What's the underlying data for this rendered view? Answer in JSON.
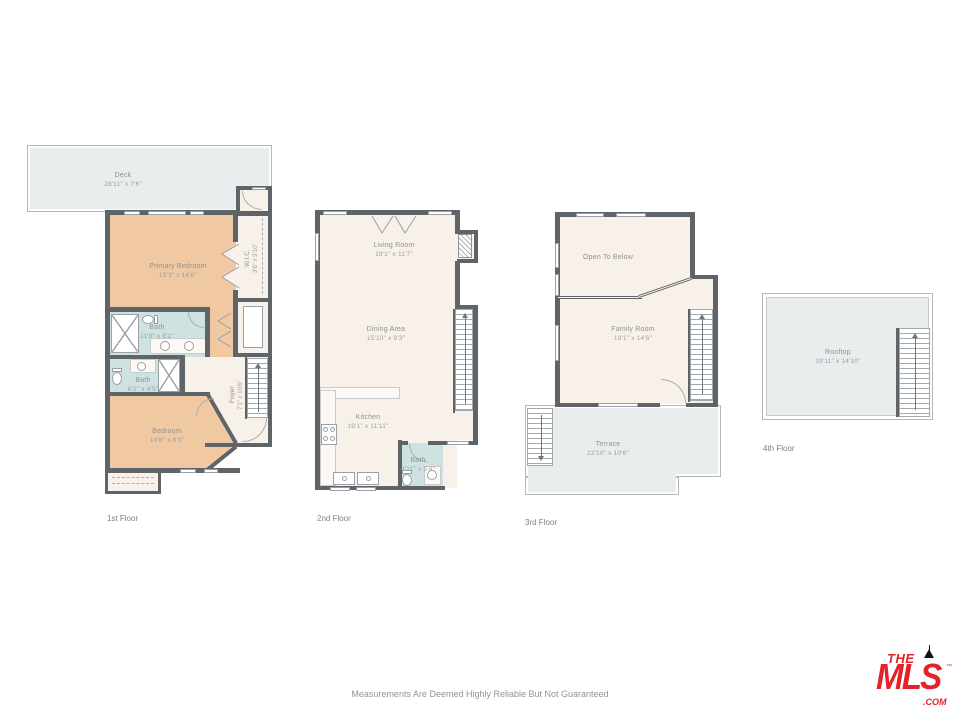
{
  "page": {
    "disclaimer": "Measurements Are Deemed Highly Reliable But Not Guaranteed"
  },
  "colors": {
    "walls": "#5f6468",
    "bedroom_tan": "#f0c9a3",
    "bath_blue": "#cfe2e2",
    "room_cream": "#f8f1e9",
    "outdoor_gray": "#eaedee",
    "logo_red": "#e62229"
  },
  "logo": {
    "the": "THE",
    "mls": "MLS",
    "tm": "™",
    "com": ".COM"
  },
  "floors": [
    {
      "label": "1st Floor",
      "rooms": [
        {
          "name": "Deck",
          "dims": "28'11\" x 7'6\""
        },
        {
          "name": "Primary Bedroom",
          "dims": "15'3\" x 16'6\""
        },
        {
          "name": "W.I.C.",
          "dims": "3'6\" x 9'10\""
        },
        {
          "name": "Bath",
          "dims": "11'8\" x 6'1\""
        },
        {
          "name": "Bath",
          "dims": "6'2\" x 4'5\""
        },
        {
          "name": "Foyer",
          "dims": "7'1\" x 10'6\""
        },
        {
          "name": "Bedroom",
          "dims": "14'6\" x 8'9\""
        }
      ]
    },
    {
      "label": "2nd Floor",
      "rooms": [
        {
          "name": "Living Room",
          "dims": "19'1\" x 11'7\""
        },
        {
          "name": "Dining Area",
          "dims": "15'10\" x 9'3\""
        },
        {
          "name": "Kitchen",
          "dims": "19'1\" x 11'11\""
        },
        {
          "name": "Bath",
          "dims": "4'11\" x 5'4\""
        }
      ]
    },
    {
      "label": "3rd Floor",
      "rooms": [
        {
          "name": "Open To Below",
          "dims": ""
        },
        {
          "name": "Family Room",
          "dims": "19'1\" x 14'6\""
        },
        {
          "name": "Terrace",
          "dims": "22'10\" x 10'6\""
        }
      ]
    },
    {
      "label": "4th Floor",
      "rooms": [
        {
          "name": "Rooftop",
          "dims": "19'11\" x 14'10\""
        }
      ]
    }
  ]
}
